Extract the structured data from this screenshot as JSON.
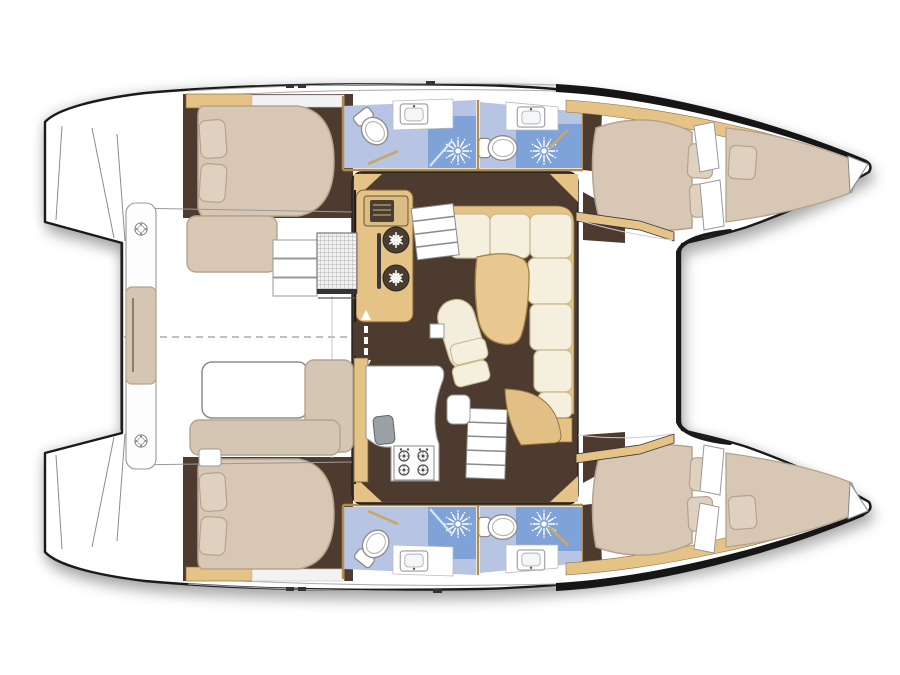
{
  "meta": {
    "title": "Catamaran yacht interior layout - overhead floor plan",
    "view": "overhead",
    "orientation": "bow-right",
    "background": "#ffffff"
  },
  "colors": {
    "outline": "#1a1a1a",
    "hull": "#ffffff",
    "floor": "#4e3b2f",
    "wood": "#e5c387",
    "wood_edge": "#8a6f3f",
    "table_wood": "#e8c88f",
    "bed": "#d8c7b5",
    "bed_edge": "#b5a48c",
    "pillow": "#e0d0bf",
    "sofa": "#f5f0de",
    "sofa_edge": "#c9b98f",
    "bath": "#b7c4e4",
    "shower": "#7fa2d8",
    "fixture": "#8a8a8a",
    "steel": "#9aa0a5",
    "deck_line": "#aaaaaa",
    "appliance": "#4a3e31",
    "sheer": "#161616",
    "wall": "#b08d4f"
  },
  "vessel": {
    "type": "sailing catamaran",
    "hulls": 2,
    "cabins": 4,
    "heads": 4,
    "layout": "salon with galley between hulls, aft cockpit with table, twin transom steps, bow forepeak berths"
  },
  "rooms": [
    {
      "id": "salon",
      "kind": "salon",
      "furniture": [
        "u-shaped-sofa",
        "curved-table",
        "chaise-seat",
        "nav-desk"
      ]
    },
    {
      "id": "galley",
      "kind": "galley",
      "appliances": [
        "double-refrigerator",
        "microwave",
        "four-burner-stove",
        "sink"
      ]
    },
    {
      "id": "port-aft-cabin",
      "kind": "cabin",
      "furniture": [
        "double-berth",
        "two-pillows",
        "shelf"
      ]
    },
    {
      "id": "starboard-aft-cabin",
      "kind": "cabin",
      "furniture": [
        "double-berth",
        "two-pillows",
        "shelf"
      ]
    },
    {
      "id": "port-forward-cabin",
      "kind": "cabin",
      "furniture": [
        "double-berth",
        "two-pillows"
      ]
    },
    {
      "id": "starboard-forward-cabin",
      "kind": "cabin",
      "furniture": [
        "double-berth",
        "two-pillows"
      ]
    },
    {
      "id": "port-forepeak",
      "kind": "berth",
      "furniture": [
        "single-berth",
        "pillow"
      ]
    },
    {
      "id": "starboard-forepeak",
      "kind": "berth",
      "furniture": [
        "single-berth",
        "pillow"
      ]
    },
    {
      "id": "port-aft-head",
      "kind": "bathroom",
      "fixtures": [
        "toilet",
        "sink",
        "shower"
      ]
    },
    {
      "id": "port-forward-head",
      "kind": "bathroom",
      "fixtures": [
        "toilet",
        "sink",
        "shower"
      ]
    },
    {
      "id": "starboard-aft-head",
      "kind": "bathroom",
      "fixtures": [
        "toilet",
        "sink",
        "shower"
      ]
    },
    {
      "id": "starboard-forward-head",
      "kind": "bathroom",
      "fixtures": [
        "toilet",
        "sink",
        "shower"
      ]
    },
    {
      "id": "cockpit",
      "kind": "cockpit",
      "furniture": [
        "bench",
        "l-shaped-sofa",
        "table",
        "mesh-locker",
        "deck-steps",
        "transom-platform-with-cushion"
      ]
    },
    {
      "id": "foredeck",
      "kind": "deck"
    },
    {
      "id": "companionway-door",
      "kind": "door",
      "symbol": "double-arrow"
    }
  ],
  "icons": [
    {
      "name": "snowflake-icon",
      "meaning": "refrigerator"
    },
    {
      "name": "sunburst-icon",
      "meaning": "shower head"
    },
    {
      "name": "toilet-icon",
      "meaning": "marine toilet"
    },
    {
      "name": "sink-icon",
      "meaning": "wash basin"
    },
    {
      "name": "burner-icon",
      "meaning": "stove burner"
    },
    {
      "name": "deck-hatch-icon",
      "meaning": "deck hatch"
    },
    {
      "name": "arrow-icon",
      "meaning": "sliding door direction"
    }
  ]
}
